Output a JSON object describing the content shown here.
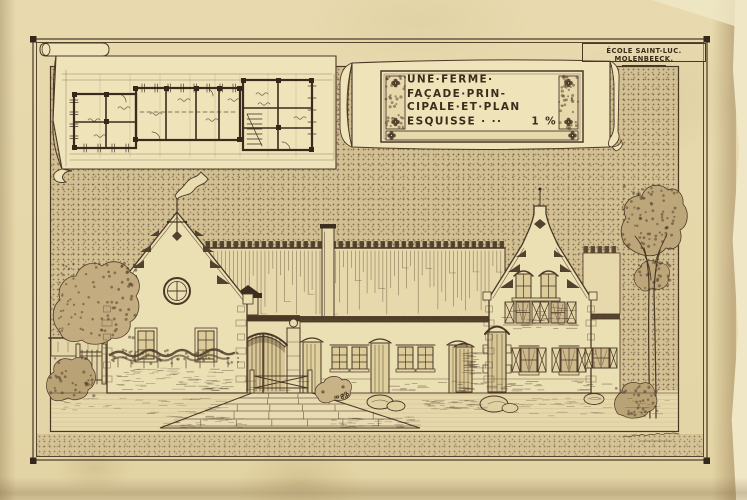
{
  "stamp": {
    "label": "ÉCOLE SAINT-LUC. MOLENBEECK."
  },
  "cartouche": {
    "line1": "UNE·FERME·",
    "line2": "FAÇADE·PRIN-",
    "line3": "CIPALE·ET·PLAN",
    "line4_left": "ESQUISSE · ··",
    "line4_scale": "1 %"
  },
  "colors": {
    "paper": "#e7d9ae",
    "ink": "#4a3826",
    "ink_dark": "#33281b",
    "stipple_base": "#d2bf92",
    "parchment": "#efe3ba"
  }
}
